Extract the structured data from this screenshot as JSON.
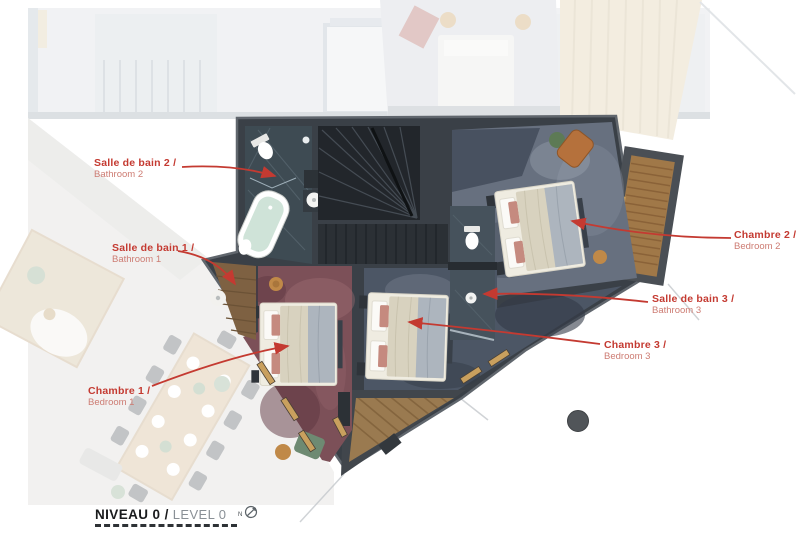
{
  "plan": {
    "title": {
      "primary": "NIVEAU 0 /",
      "secondary": "LEVEL 0",
      "compass_n": "N"
    },
    "labels": [
      {
        "id": "bathroom-2",
        "fr": "Salle de bain 2 /",
        "en": "Bathroom 2"
      },
      {
        "id": "bathroom-1",
        "fr": "Salle de bain 1 /",
        "en": "Bathroom 1"
      },
      {
        "id": "bedroom-1",
        "fr": "Chambre 1 /",
        "en": "Bedroom 1"
      },
      {
        "id": "bedroom-2",
        "fr": "Chambre 2 /",
        "en": "Bedroom 2"
      },
      {
        "id": "bathroom-3",
        "fr": "Salle de bain 3 /",
        "en": "Bathroom 3"
      },
      {
        "id": "bedroom-3",
        "fr": "Chambre 3 /",
        "en": "Bedroom 3"
      }
    ],
    "colors": {
      "accent_red": "#c43a31",
      "accent_red_light": "#cd7c73",
      "wall_dark": "#3a4047",
      "slate_floor": "#3e4b53",
      "carpet_bedroom1": "#7c5058",
      "carpet_bedroom2": "#67707f",
      "carpet_bedroom3": "#4c5665",
      "wood_deck": "#9a7a50",
      "title_dark": "#1a1b1d",
      "title_gray": "#8a9096"
    }
  }
}
